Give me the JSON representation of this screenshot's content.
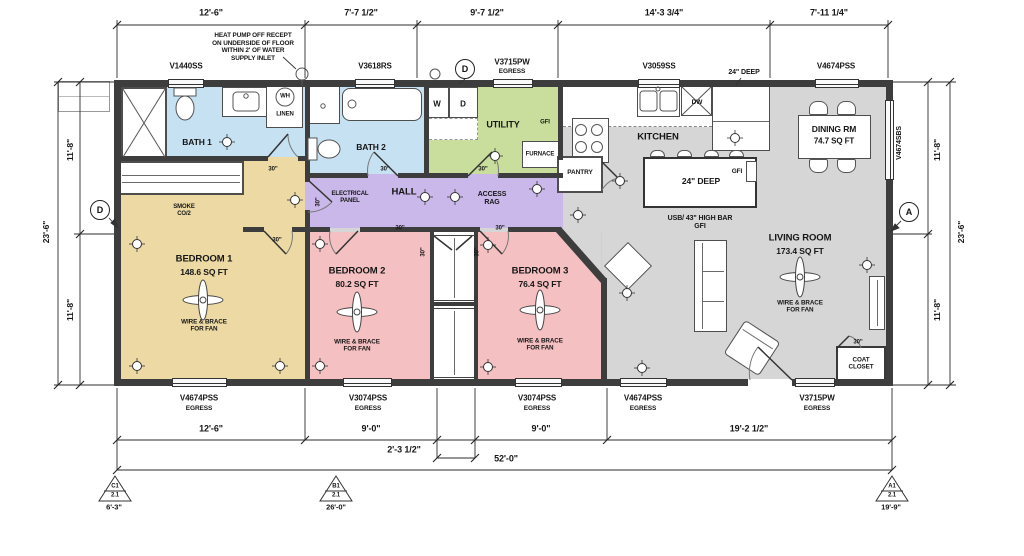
{
  "colors": {
    "wall": "#3d3d3d",
    "bath": "#c5e1f2",
    "utility": "#c9de9d",
    "hall": "#c9b8e9",
    "bedroom1": "#ecd9a3",
    "bedroom23": "#f5c0c2",
    "common": "#d6d6d7"
  },
  "dims": {
    "top": [
      "12'-6\"",
      "7'-7 1/2\"",
      "9'-7 1/2\"",
      "14'-3 3/4\"",
      "7'-11 1/4\""
    ],
    "bottom": [
      "12'-6\"",
      "9'-0\"",
      "9'-0\"",
      "19'-2 1/2\""
    ],
    "bottom_offset": "2'-3 1/2\"",
    "bottom_total": "52'-0\"",
    "side_half": "11'-8\"",
    "side_total": "23'-6\""
  },
  "notes": {
    "heat_pump": "HEAT PUMP OFF RECEPT\nON UNDERSIDE OF FLOOR\nWITHIN 2' OF WATER\nSUPPLY INLET",
    "counter_depth": "24\" DEEP",
    "island_depth": "24\" DEEP",
    "usb_bar": "USB/ 43\" HIGH BAR\nGFI",
    "door_width": "30\"",
    "smoke": "SMOKE\nCO/2",
    "electrical": "ELECTRICAL\nPANEL",
    "access": "ACCESS\nRAG",
    "wire_fan": "WIRE & BRACE\nFOR FAN",
    "gfi": "GFI"
  },
  "windows": {
    "top": [
      "V1440SS",
      "V3618RS",
      "V3715PW",
      "V3059SS",
      "V4674PSS"
    ],
    "right": "V4674SBS",
    "bottom": [
      "V4674PSS",
      "V3074PSS",
      "V3074PSS",
      "V4674PSS",
      "V3715PW"
    ],
    "egress": "EGRESS"
  },
  "rooms": {
    "bath1": "BATH 1",
    "bath2": "BATH 2",
    "utility": "UTILITY",
    "hall": "HALL",
    "kitchen": "KITCHEN",
    "pantry": "PANTRY",
    "dining": {
      "name": "DINING RM",
      "area": "74.7 SQ FT"
    },
    "living": {
      "name": "LIVING ROOM",
      "area": "173.4 SQ FT"
    },
    "bed1": {
      "name": "BEDROOM 1",
      "area": "148.6 SQ FT"
    },
    "bed2": {
      "name": "BEDROOM 2",
      "area": "80.2 SQ FT"
    },
    "bed3": {
      "name": "BEDROOM 3",
      "area": "76.4 SQ FT"
    },
    "coat": "COAT\nCLOSET"
  },
  "fixtures": {
    "washer": "W",
    "dryer": "D",
    "dishwasher": "DW",
    "furnace": "FURNACE",
    "water_heater": "WH",
    "linen": "LINEN"
  },
  "markers": {
    "a": "A",
    "d": "D",
    "triangles": [
      {
        "id": "C1",
        "sheet": "2.1",
        "offset": "6'-3\""
      },
      {
        "id": "B1",
        "sheet": "2.1",
        "offset": "26'-0\""
      },
      {
        "id": "A1",
        "sheet": "2.1",
        "offset": "19'-9\""
      }
    ]
  }
}
